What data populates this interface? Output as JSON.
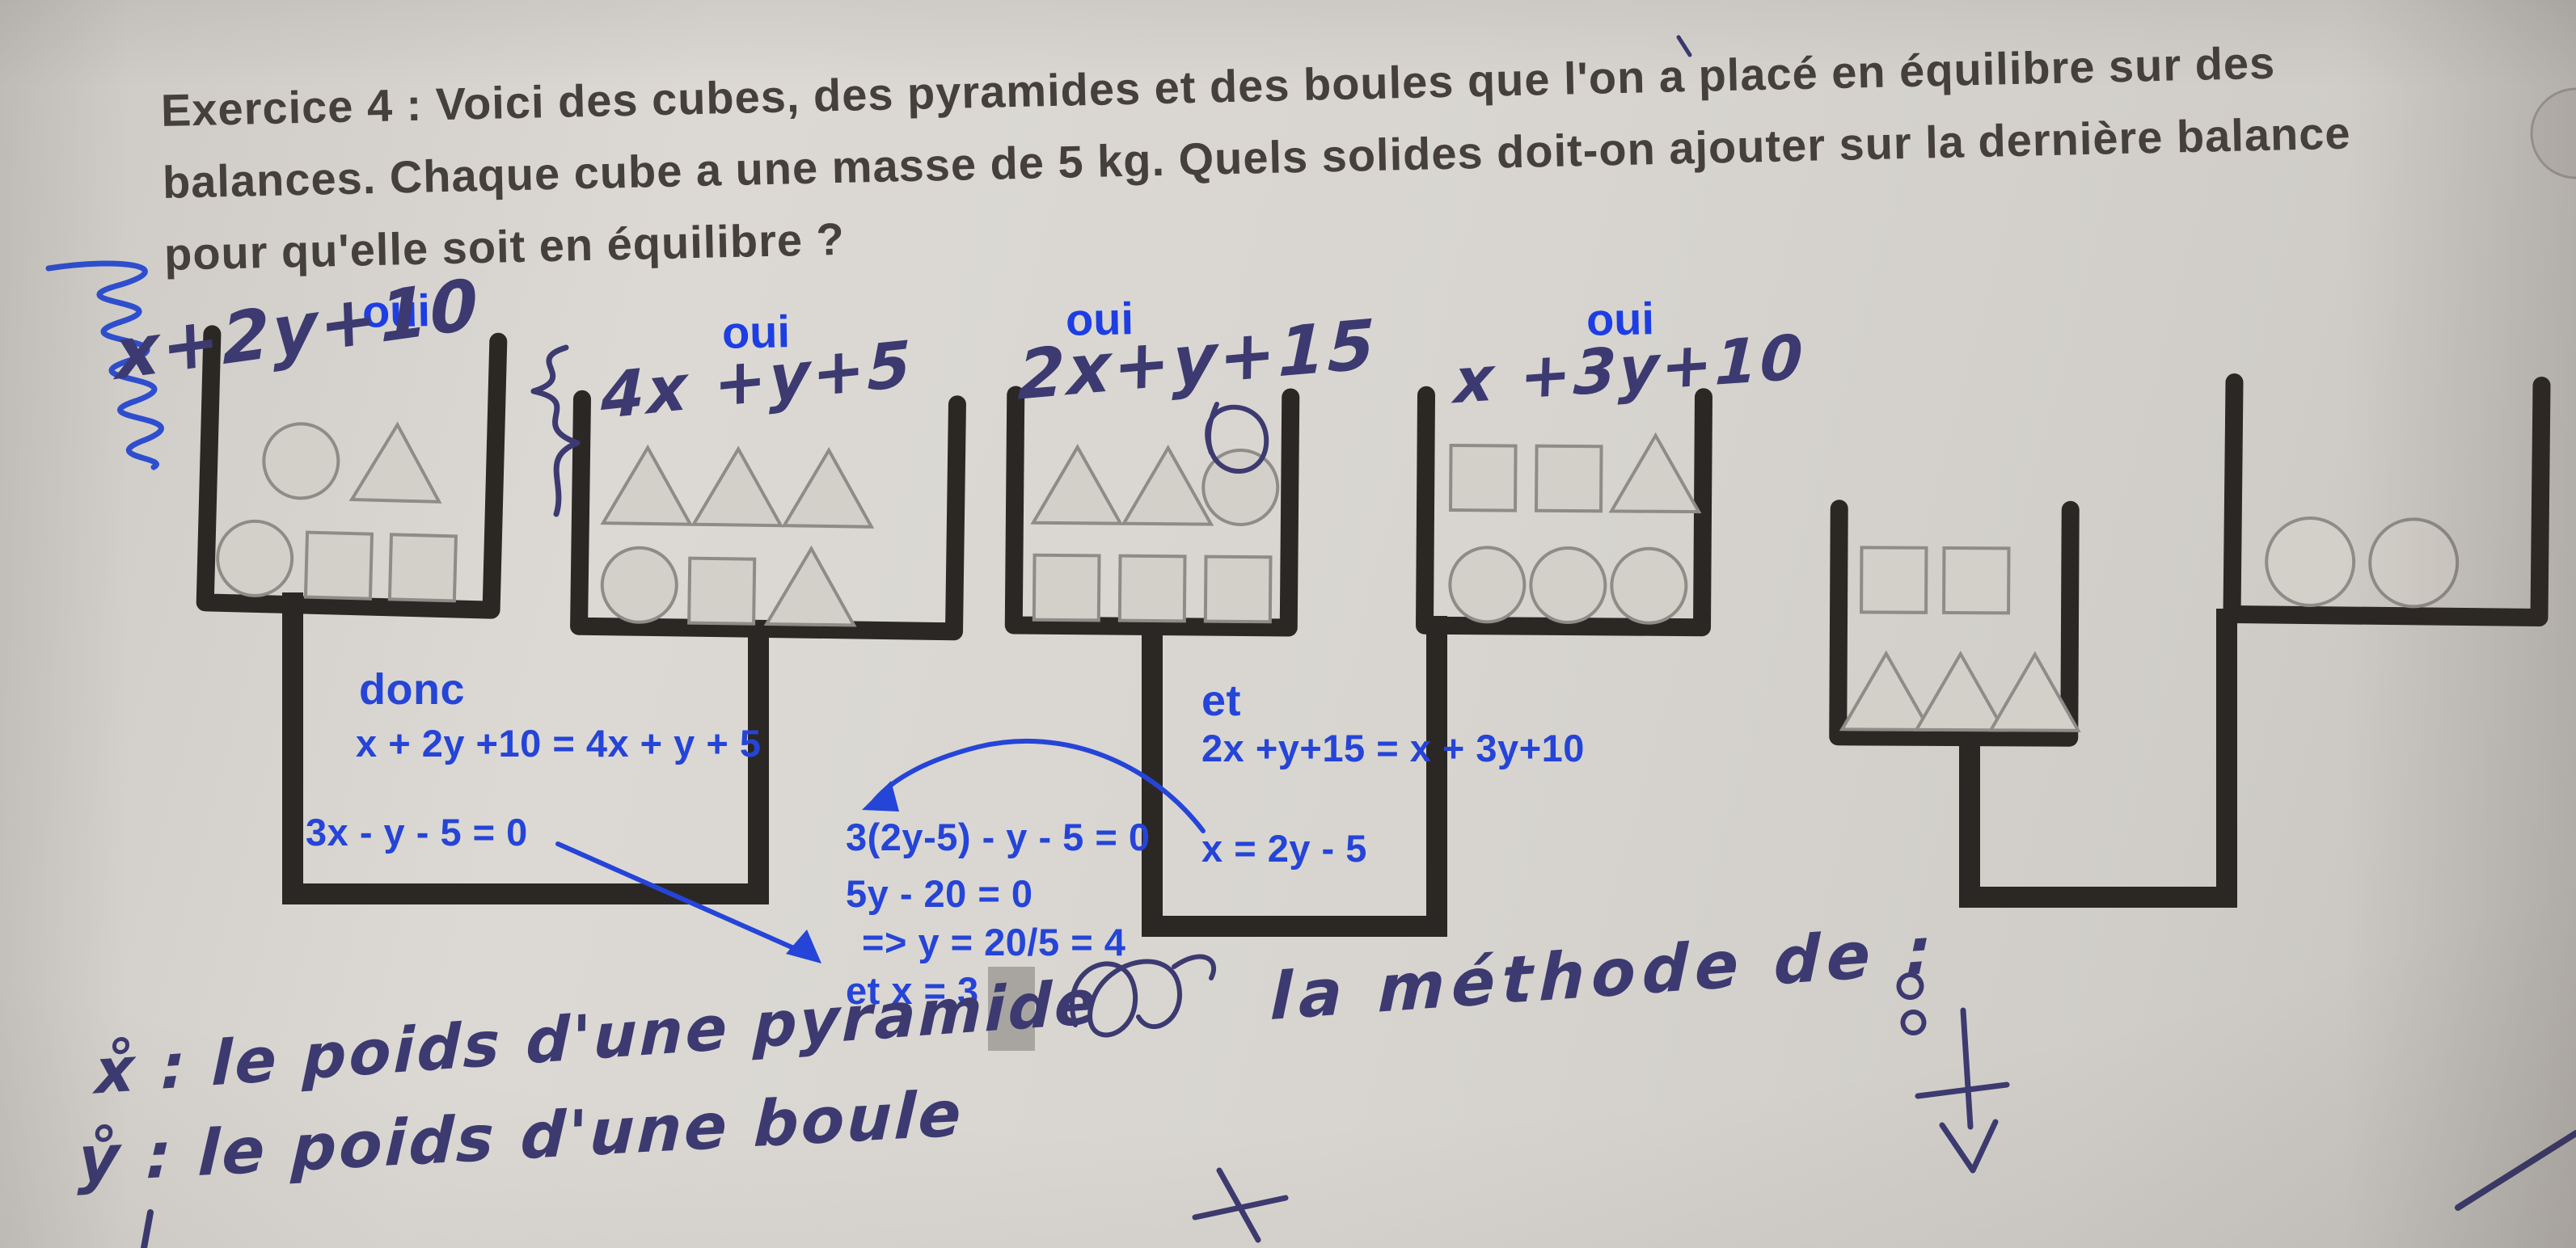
{
  "document_kind": "photo of a math worksheet with handwritten and typed annotations",
  "header": {
    "line1": "Exercice 4 :  Voici des cubes, des pyramides et des boules que l'on a placé en équilibre sur des",
    "line2": "balances.  Chaque cube a une masse de 5 kg.  Quels solides doit-on ajouter sur la dernière balance",
    "line3": "pour qu'elle soit en équilibre ?"
  },
  "pans": [
    {
      "balance": 1,
      "side": "left",
      "verdict": "oui",
      "expression": "x+2y+10",
      "top_shapes": [
        "circle",
        "triangle"
      ],
      "bottom_shapes": [
        "circle",
        "square",
        "square"
      ]
    },
    {
      "balance": 1,
      "side": "right",
      "verdict": "oui",
      "expression": "4x +y+5",
      "top_shapes": [
        "triangle",
        "triangle",
        "triangle"
      ],
      "bottom_shapes": [
        "circle",
        "square",
        "triangle"
      ]
    },
    {
      "balance": 2,
      "side": "left",
      "verdict": "oui",
      "expression": "2x+y+15",
      "top_shapes": [
        "triangle",
        "triangle",
        "circle"
      ],
      "bottom_shapes": [
        "square",
        "square",
        "square"
      ]
    },
    {
      "balance": 2,
      "side": "right",
      "verdict": "oui",
      "expression": "x +3y+10",
      "top_shapes": [
        "square",
        "square",
        "triangle"
      ],
      "bottom_shapes": [
        "circle",
        "circle",
        "circle"
      ]
    },
    {
      "balance": 3,
      "side": "left",
      "expression": "",
      "top_shapes": [
        "square",
        "square"
      ],
      "bottom_shapes": [
        "triangle",
        "triangle",
        "triangle"
      ]
    },
    {
      "balance": 3,
      "side": "right",
      "expression": "",
      "top_shapes": [],
      "bottom_shapes": [
        "circle",
        "circle"
      ]
    }
  ],
  "annotations_typed": {
    "left_block": {
      "intro": "donc",
      "eq1": "x + 2y +10 = 4x + y + 5",
      "eq2": "3x - y - 5 = 0"
    },
    "middle_block": {
      "eq1": "3(2y-5) - y - 5 = 0",
      "eq2": "5y - 20 = 0",
      "eq3": "=> y = 20/5 = 4",
      "eq4": "et x = 3"
    },
    "right_block": {
      "intro": "et",
      "eq1": "2x +y+15 = x + 3y+10",
      "eq2": "x = 2y - 5"
    }
  },
  "annotations_pen": {
    "note_line1": "x̊ : le poids d'une pyramide",
    "note_line2": "ẙ : le poids d'une boule",
    "note_method": "la méthode de :"
  },
  "colors": {
    "paper": "#d8d5d0",
    "structure_ink": "#2b2724",
    "shape_fill": "#d3cfc9",
    "shape_edge": "#8f8c87",
    "typed_blue": "#2544d8",
    "pen_navy": "#3c3a70",
    "pen_blue": "#2e4ecf",
    "correction_gray": "#a8a5a1"
  }
}
